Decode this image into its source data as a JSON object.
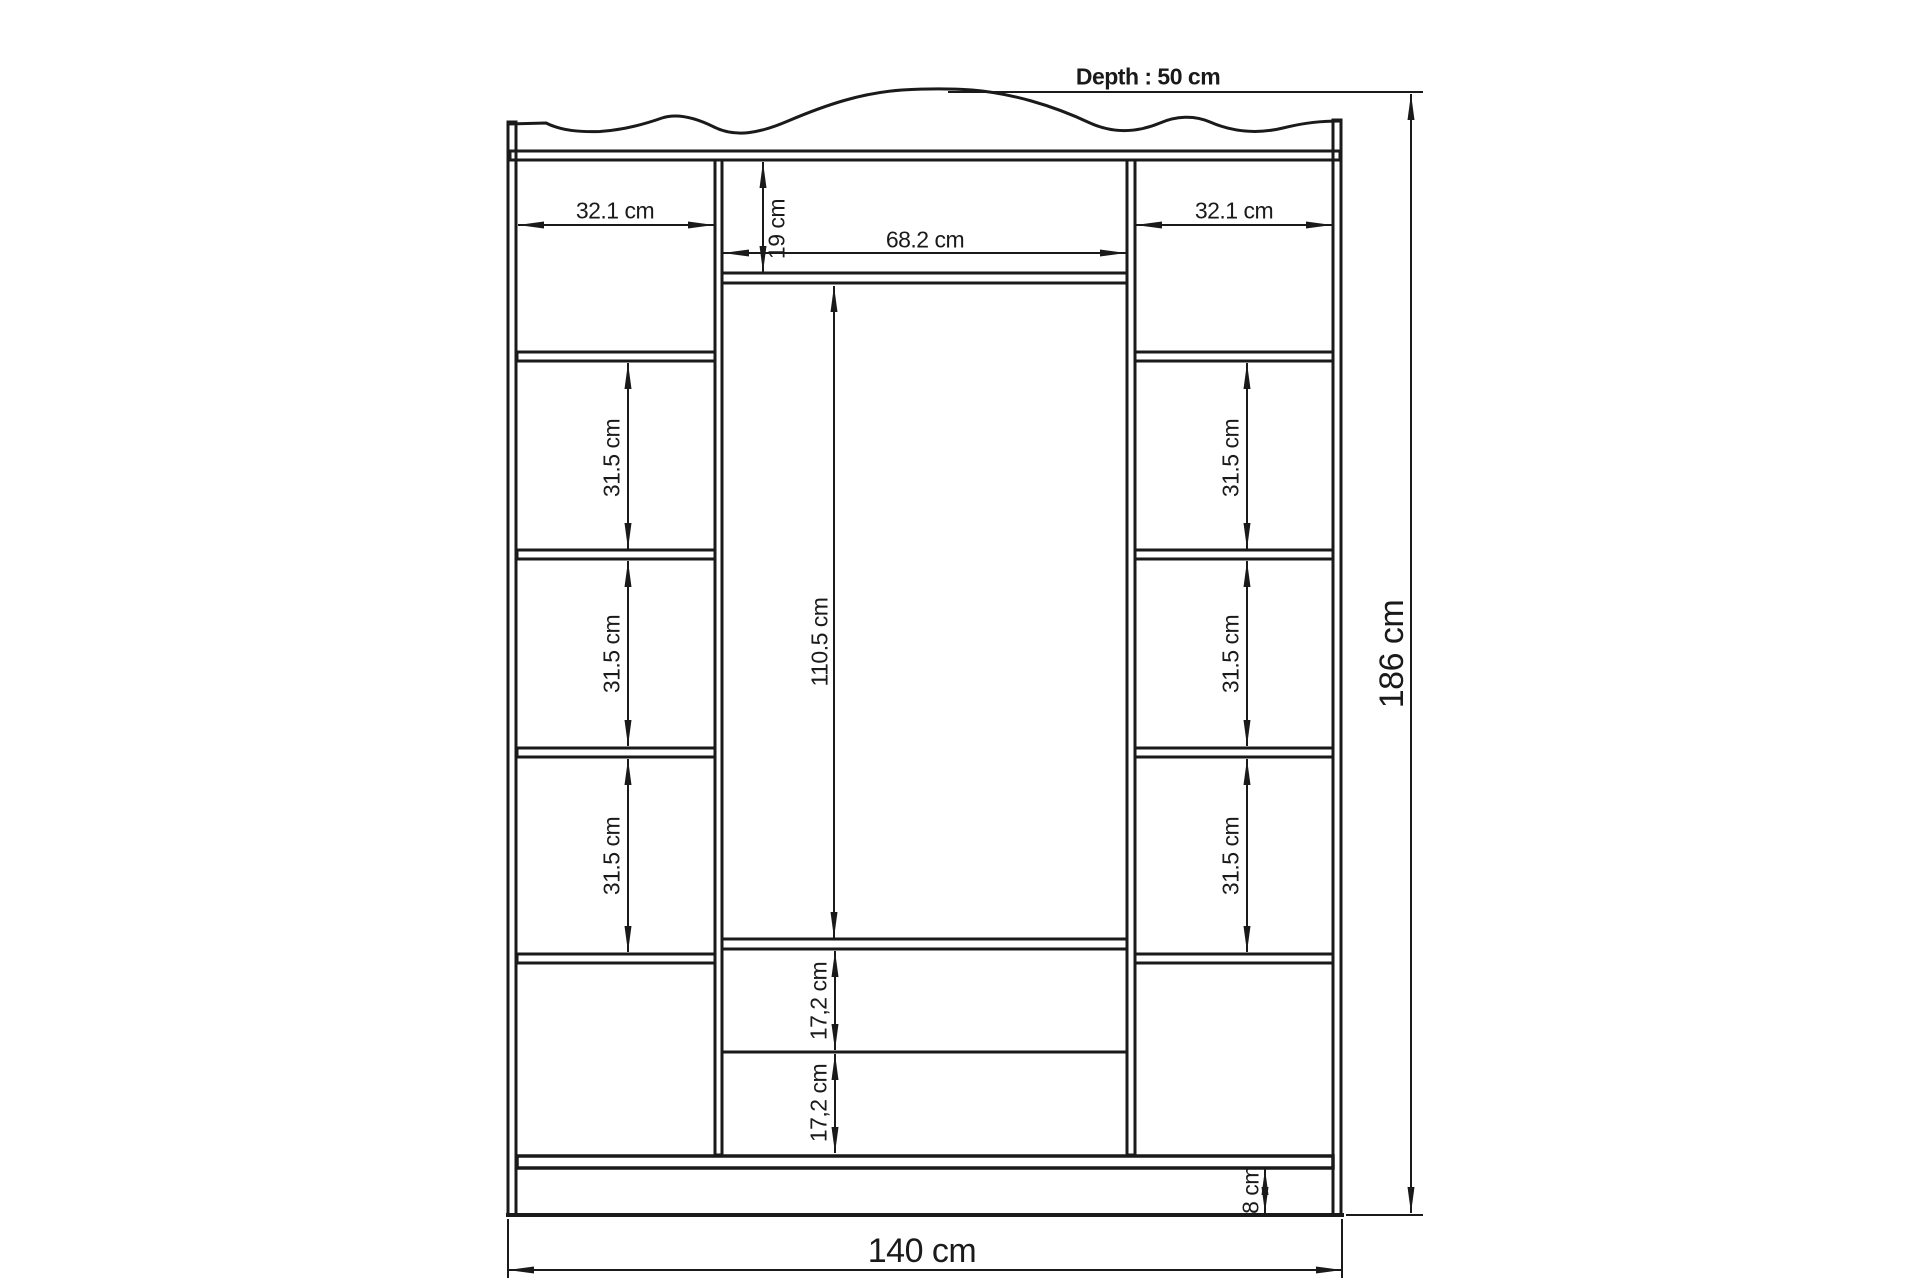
{
  "labels": {
    "depth": "Depth : 50 cm",
    "total_width": "140 cm",
    "total_height": "186 cm",
    "side_width": "32.1 cm",
    "center_width": "68.2 cm",
    "top_gap": "19 cm",
    "middle_height": "110.5 cm",
    "shelf_gap": "31.5 cm",
    "drawer_gap": "17,2 cm",
    "base_height": "8 cm"
  },
  "colors": {
    "line": "#1a1a1a",
    "background": "#ffffff"
  }
}
